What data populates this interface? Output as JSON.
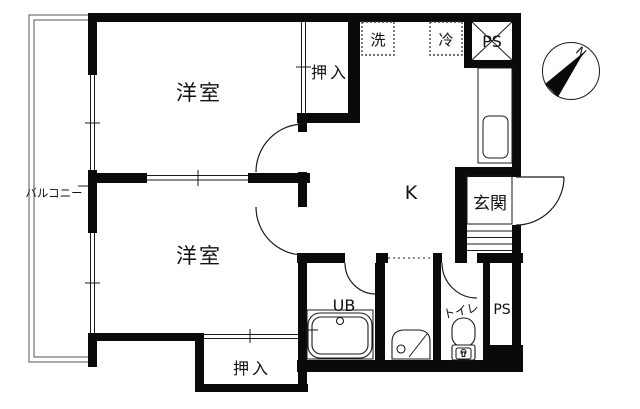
{
  "title": "apartment-floor-plan",
  "colors": {
    "wall": "#0a0a0a",
    "line": "#1a1a1a",
    "background": "#ffffff"
  },
  "rooms": {
    "bedroom_upper": "洋室",
    "bedroom_lower": "洋室",
    "kitchen": "K",
    "entrance": "玄関",
    "unit_bath": "UB",
    "toilet": "トイレ",
    "balcony": "バルコニー",
    "closet_upper": "押入",
    "closet_lower": "押入",
    "pipe_space_top": "PS",
    "pipe_space_bottom": "PS",
    "washer_space": "洗",
    "refrigerator_space": "冷"
  },
  "compass": {
    "north_label": "N"
  }
}
